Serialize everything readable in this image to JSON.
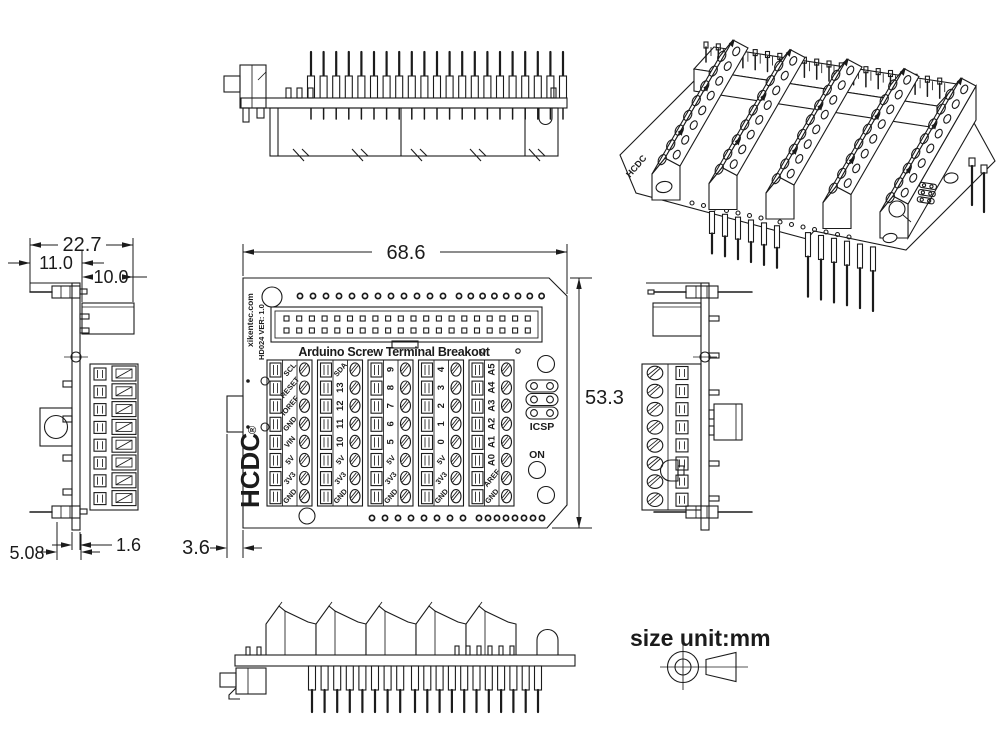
{
  "page": {
    "unit_label": "size unit:mm"
  },
  "dims": {
    "left_total_width": "22.7",
    "left_pin_offset": "11.0",
    "left_body_width": "10.0",
    "pin_pitch": "5.08",
    "pcb_thickness": "1.6",
    "board_width": "68.6",
    "board_height": "53.3",
    "edge_offset": "3.6"
  },
  "board": {
    "title": "Arduino Screw Terminal Breakout",
    "brand_url": "xikentec.com",
    "model_version": "HD024 VER: 1.0",
    "logo": "HCDC",
    "registered_mark": "®",
    "iso_logo": "HCDC",
    "icsp_label": "ICSP",
    "led_label": "ON",
    "terminal_groups": [
      {
        "name": "power",
        "labels": [
          "SCL",
          "RESET",
          "IOREF",
          "GND",
          "VIN",
          "5V",
          "3V3",
          "GND"
        ]
      },
      {
        "name": "digital-13-10",
        "labels": [
          "SDA",
          "13",
          "12",
          "11",
          "10",
          "5V",
          "3V3",
          "GND"
        ]
      },
      {
        "name": "digital-9-5",
        "labels": [
          "9",
          "8",
          "7",
          "6",
          "5",
          "5V",
          "3V3",
          "GND"
        ]
      },
      {
        "name": "digital-4-0",
        "labels": [
          "4",
          "3",
          "2",
          "1",
          "0",
          "5V",
          "3V3",
          "GND"
        ]
      },
      {
        "name": "analog",
        "labels": [
          "A5",
          "A4",
          "A3",
          "A2",
          "A1",
          "A0",
          "AREF",
          "GND"
        ]
      }
    ],
    "header_pins_per_row": 20,
    "top_hole_groups": [
      12,
      8
    ],
    "bottom_hole_groups": [
      8,
      8
    ],
    "rear_pin_count": 21,
    "front_pin_clusters": [
      8,
      11
    ],
    "icsp_rows": 3,
    "terminal_positions": 8
  },
  "colors": {
    "line": "#1b1b1b",
    "background": "#ffffff"
  }
}
